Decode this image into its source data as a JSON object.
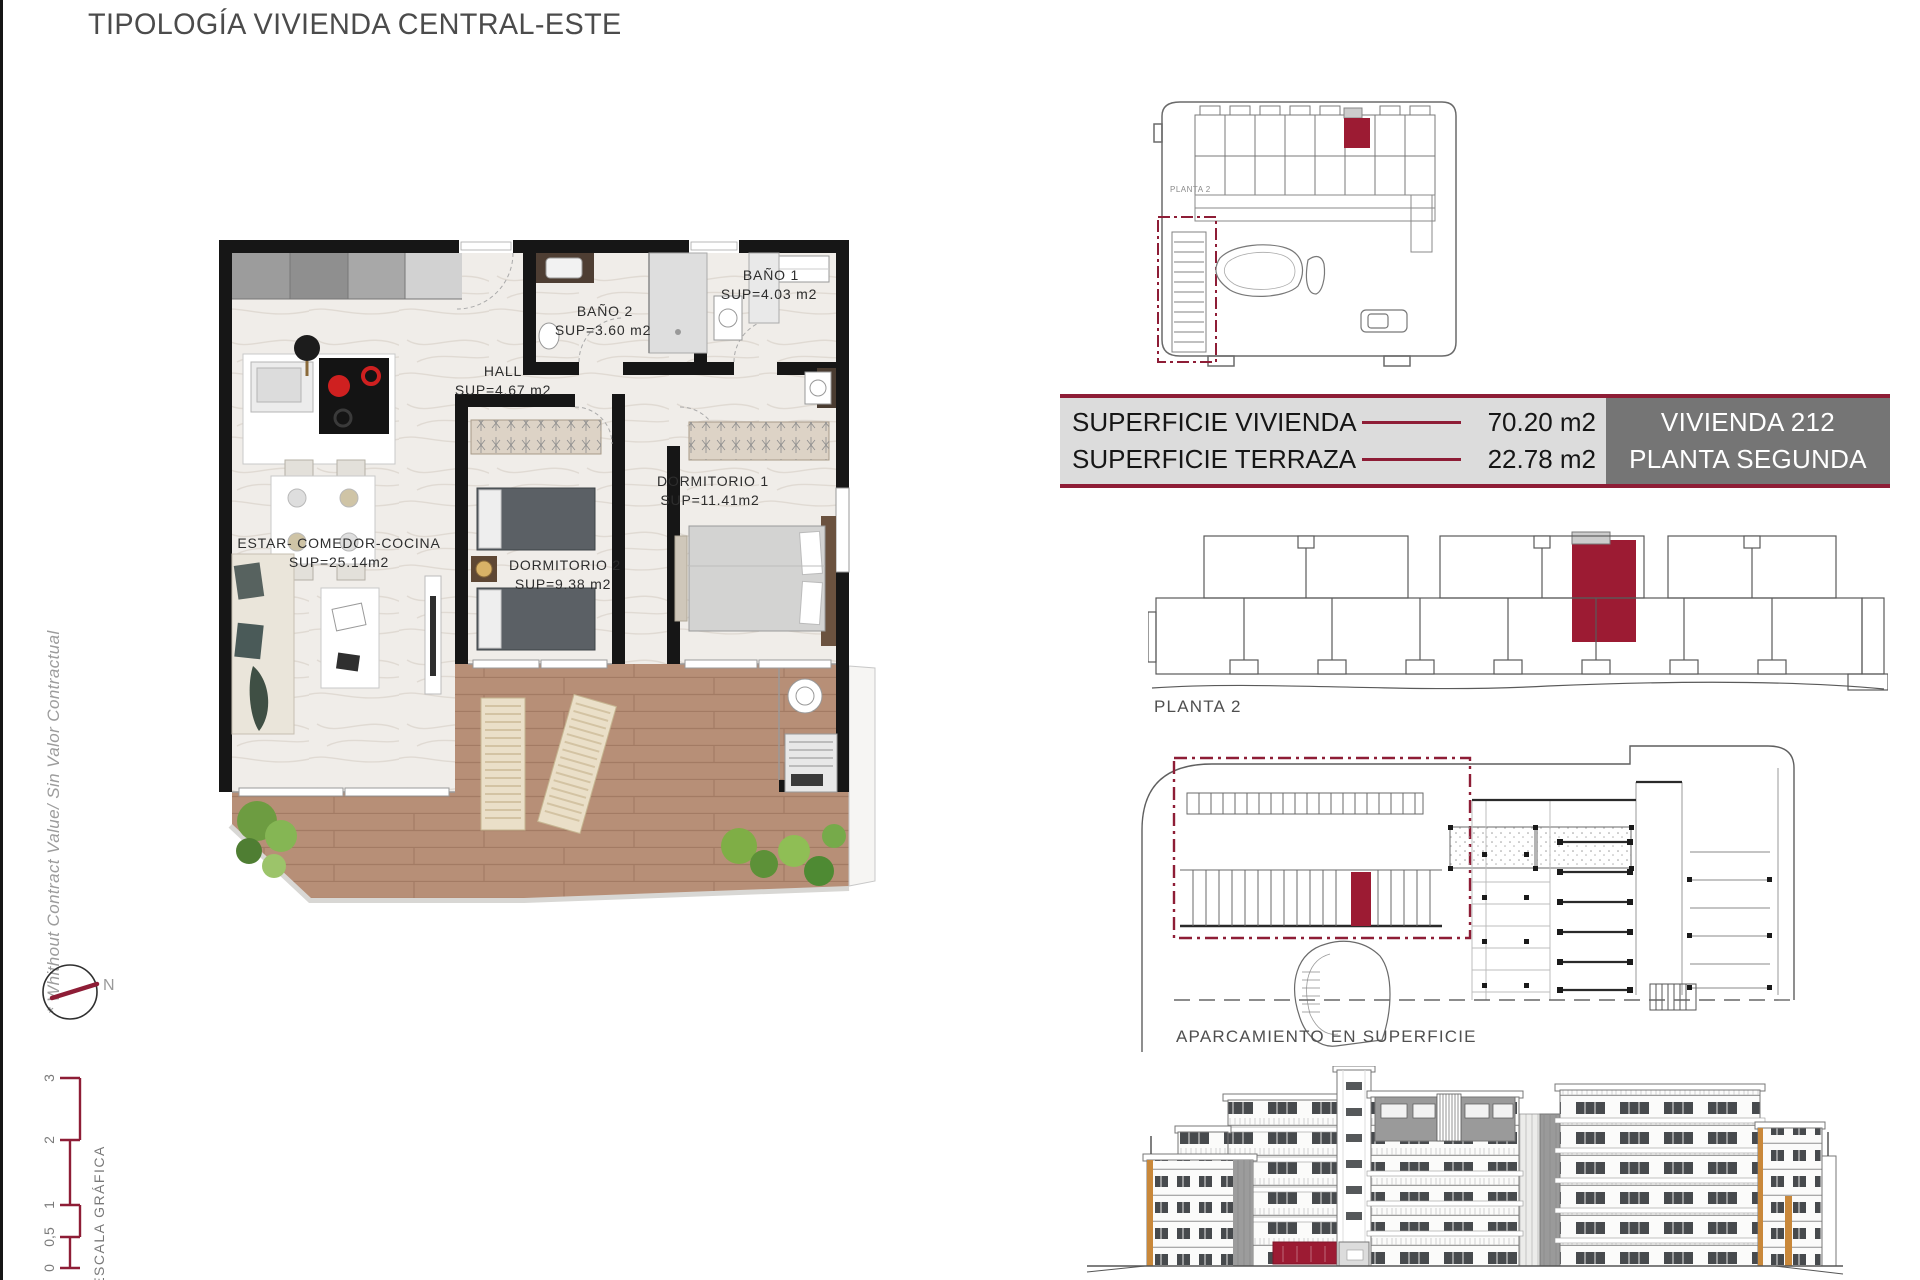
{
  "title": "TIPOLOGÍA VIVIENDA CENTRAL-ESTE",
  "side_note": "* Whithout Contract Value/ Sin Valor Contractual",
  "compass": {
    "n": "N"
  },
  "scale": {
    "label": "ESCALA GRÁFICA",
    "ticks": [
      "0",
      "0,5",
      "1",
      "2",
      "3"
    ]
  },
  "floor_plan": {
    "rooms": [
      {
        "name": "ESTAR- COMEDOR-COCINA",
        "area": "SUP=25.14m2"
      },
      {
        "name": "HALL",
        "area": "SUP=4.67 m2"
      },
      {
        "name": "BAÑO 2",
        "area": "SUP=3.60 m2"
      },
      {
        "name": "BAÑO 1",
        "area": "SUP=4.03 m2"
      },
      {
        "name": "DORMITORIO 2",
        "area": "SUP=9.38 m2"
      },
      {
        "name": "DORMITORIO 1",
        "area": "SUP=11.41m2"
      }
    ]
  },
  "summary_table": {
    "rows": [
      {
        "label": "SUPERFICIE VIVIENDA",
        "value": "70.20 m2"
      },
      {
        "label": "SUPERFICIE TERRAZA",
        "value": "22.78 m2"
      }
    ],
    "unit_box": {
      "line1": "VIVIENDA 212",
      "line2": "PLANTA SEGUNDA"
    }
  },
  "diagrams": {
    "site_plan_label": "PLANTA 2",
    "key_plan_label": "PLANTA 2",
    "parking_label": "APARCAMIENTO EN SUPERFICIE"
  },
  "colors": {
    "maroon": "#9C1B33",
    "maroon_dark": "#8E1D36",
    "table_bg": "#DCDCDC",
    "unit_box_bg": "#757575",
    "wood": "#B78F77",
    "orange_accent": "#C9883A",
    "line": "#5A5A5A"
  }
}
